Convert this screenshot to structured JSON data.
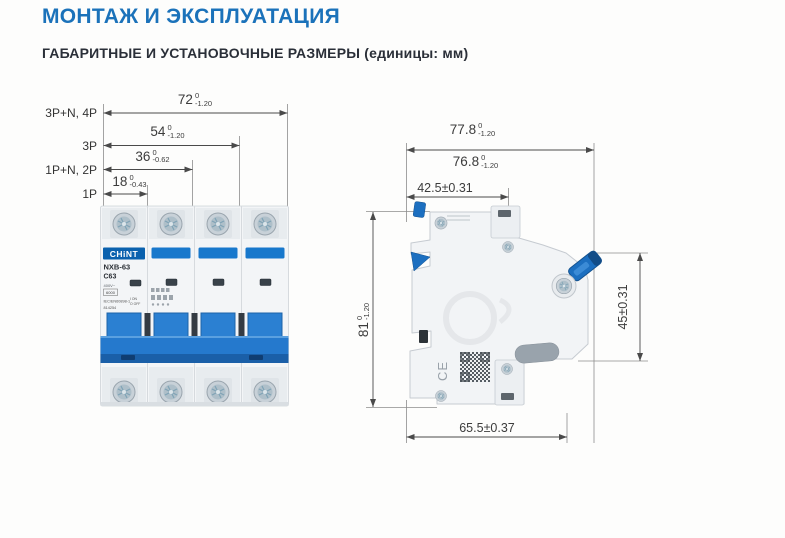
{
  "header": {
    "title": "МОНТАЖ И ЭКСПЛУАТАЦИЯ",
    "subtitle": "ГАБАРИТНЫЕ И УСТАНОВОЧНЫЕ РАЗМЕРЫ (единицы: мм)"
  },
  "front_view": {
    "pole_labels": [
      "3P+N, 4P",
      "3P",
      "1P+N, 2P",
      "1P"
    ],
    "dims": [
      {
        "value": "72",
        "tol_top": "0",
        "tol_bot": "-1.20"
      },
      {
        "value": "54",
        "tol_top": "0",
        "tol_bot": "-1.20"
      },
      {
        "value": "36",
        "tol_top": "0",
        "tol_bot": "-0.62"
      },
      {
        "value": "18",
        "tol_top": "0",
        "tol_bot": "-0.43"
      }
    ],
    "device": {
      "brand": "CHiNT",
      "model": "NXB-63",
      "rating": "C63",
      "voltage": "400V~",
      "breaking_capacity": "6000",
      "standard": "IEC/EN60898-1",
      "code": "814254",
      "on_mark": "I ON",
      "off_mark": "O OFF"
    }
  },
  "side_view": {
    "dims": {
      "total_depth": {
        "value": "77.8",
        "tol_top": "0",
        "tol_bot": "-1.20"
      },
      "depth_no_clip": {
        "value": "76.8",
        "tol_top": "0",
        "tol_bot": "-1.20"
      },
      "front_depth": {
        "value": "42.5±0.31"
      },
      "height": {
        "value": "81",
        "tol_top": "0",
        "tol_bot": "-1.20"
      },
      "front_height": {
        "value": "45±0.31"
      },
      "base_depth": {
        "value": "65.5±0.37"
      }
    },
    "ce_mark": "CE"
  },
  "colors": {
    "accent_blue": "#1b72ba",
    "breaker_blue": "#2579cd",
    "logo_blue": "#0a61ae"
  }
}
